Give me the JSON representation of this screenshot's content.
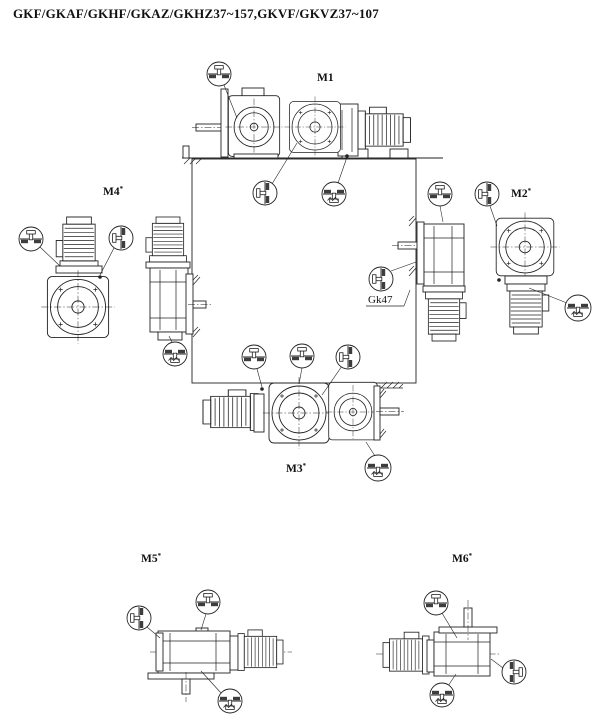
{
  "title": "GKF/GKAF/GKHF/GKAZ/GKHZ37~157,GKVF/GKVZ37~107",
  "positions": {
    "m1": {
      "label": "M1",
      "sup": ""
    },
    "m2": {
      "label": "M2",
      "sup": "*"
    },
    "m3": {
      "label": "M3",
      "sup": "*"
    },
    "m4": {
      "label": "M4",
      "sup": "*"
    },
    "m5": {
      "label": "M5",
      "sup": "*"
    },
    "m6": {
      "label": "M6",
      "sup": "*"
    }
  },
  "callouts": {
    "gearbox_code": "Gk47"
  },
  "icons": {
    "breather_plug": "breather-plug-top-icon",
    "oil_plug_side_left": "oil-plug-side-left-icon",
    "oil_plug_side_right": "oil-plug-side-right-icon",
    "oil_drain_plug": "oil-drain-plug-bottom-icon"
  },
  "colors": {
    "background": "#ffffff",
    "line": "#222222",
    "hatch": "#3d3d3d"
  }
}
